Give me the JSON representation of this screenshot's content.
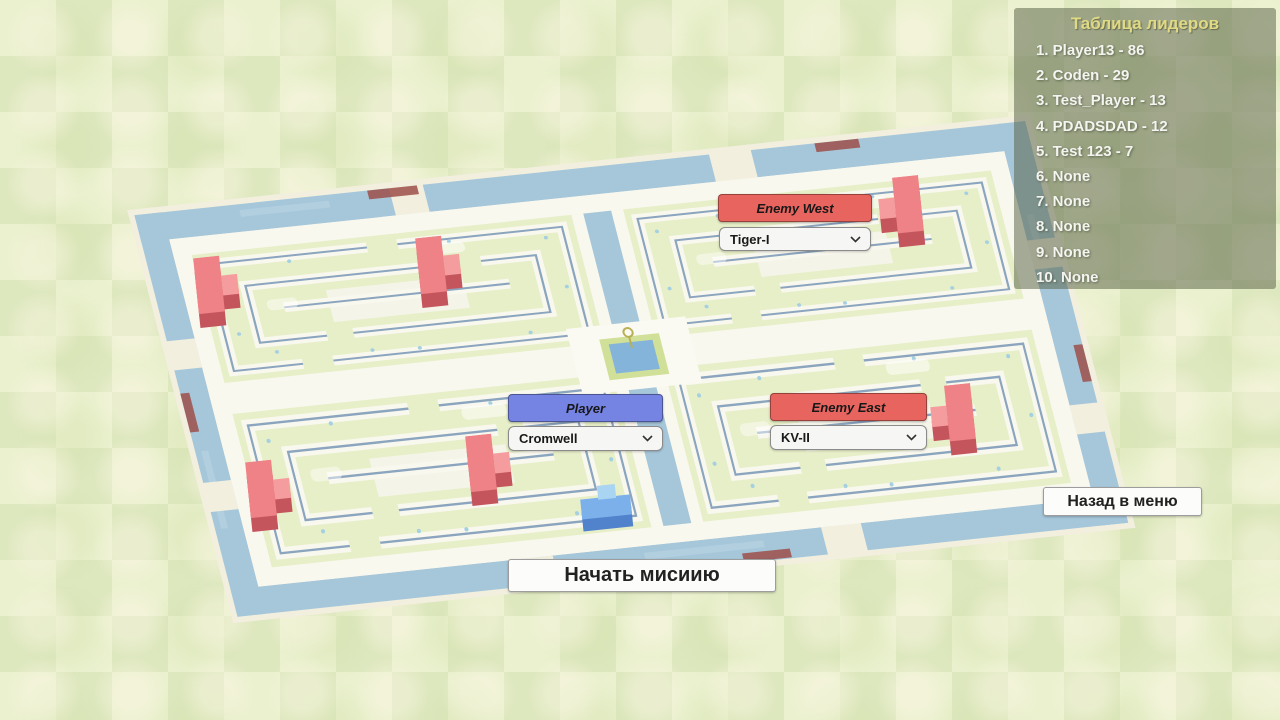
{
  "leaderboard": {
    "title": "Таблица лидеров",
    "entries": [
      "1. Player13 - 86",
      "2. Coden - 29",
      "3. Test_Player - 13",
      "4. PDADSDAD - 12",
      "5. Test 123 - 7",
      "6. None",
      "7. None",
      "8. None",
      "9. None",
      "10. None"
    ]
  },
  "selectors": {
    "enemy_west": {
      "label": "Enemy West",
      "value": "Tiger-I"
    },
    "player": {
      "label": "Player",
      "value": "Cromwell"
    },
    "enemy_east": {
      "label": "Enemy East",
      "value": "KV-II"
    }
  },
  "buttons": {
    "start_mission": "Начать мисиию",
    "back_to_menu": "Назад в меню"
  },
  "colors": {
    "enemy_header": "#e8655f",
    "player_header": "#7583e3",
    "water": "#a6c7da",
    "enemy_tank": "#ee8287",
    "player_tank": "#7cb0ea",
    "leaderboard_title": "#e0da84"
  }
}
